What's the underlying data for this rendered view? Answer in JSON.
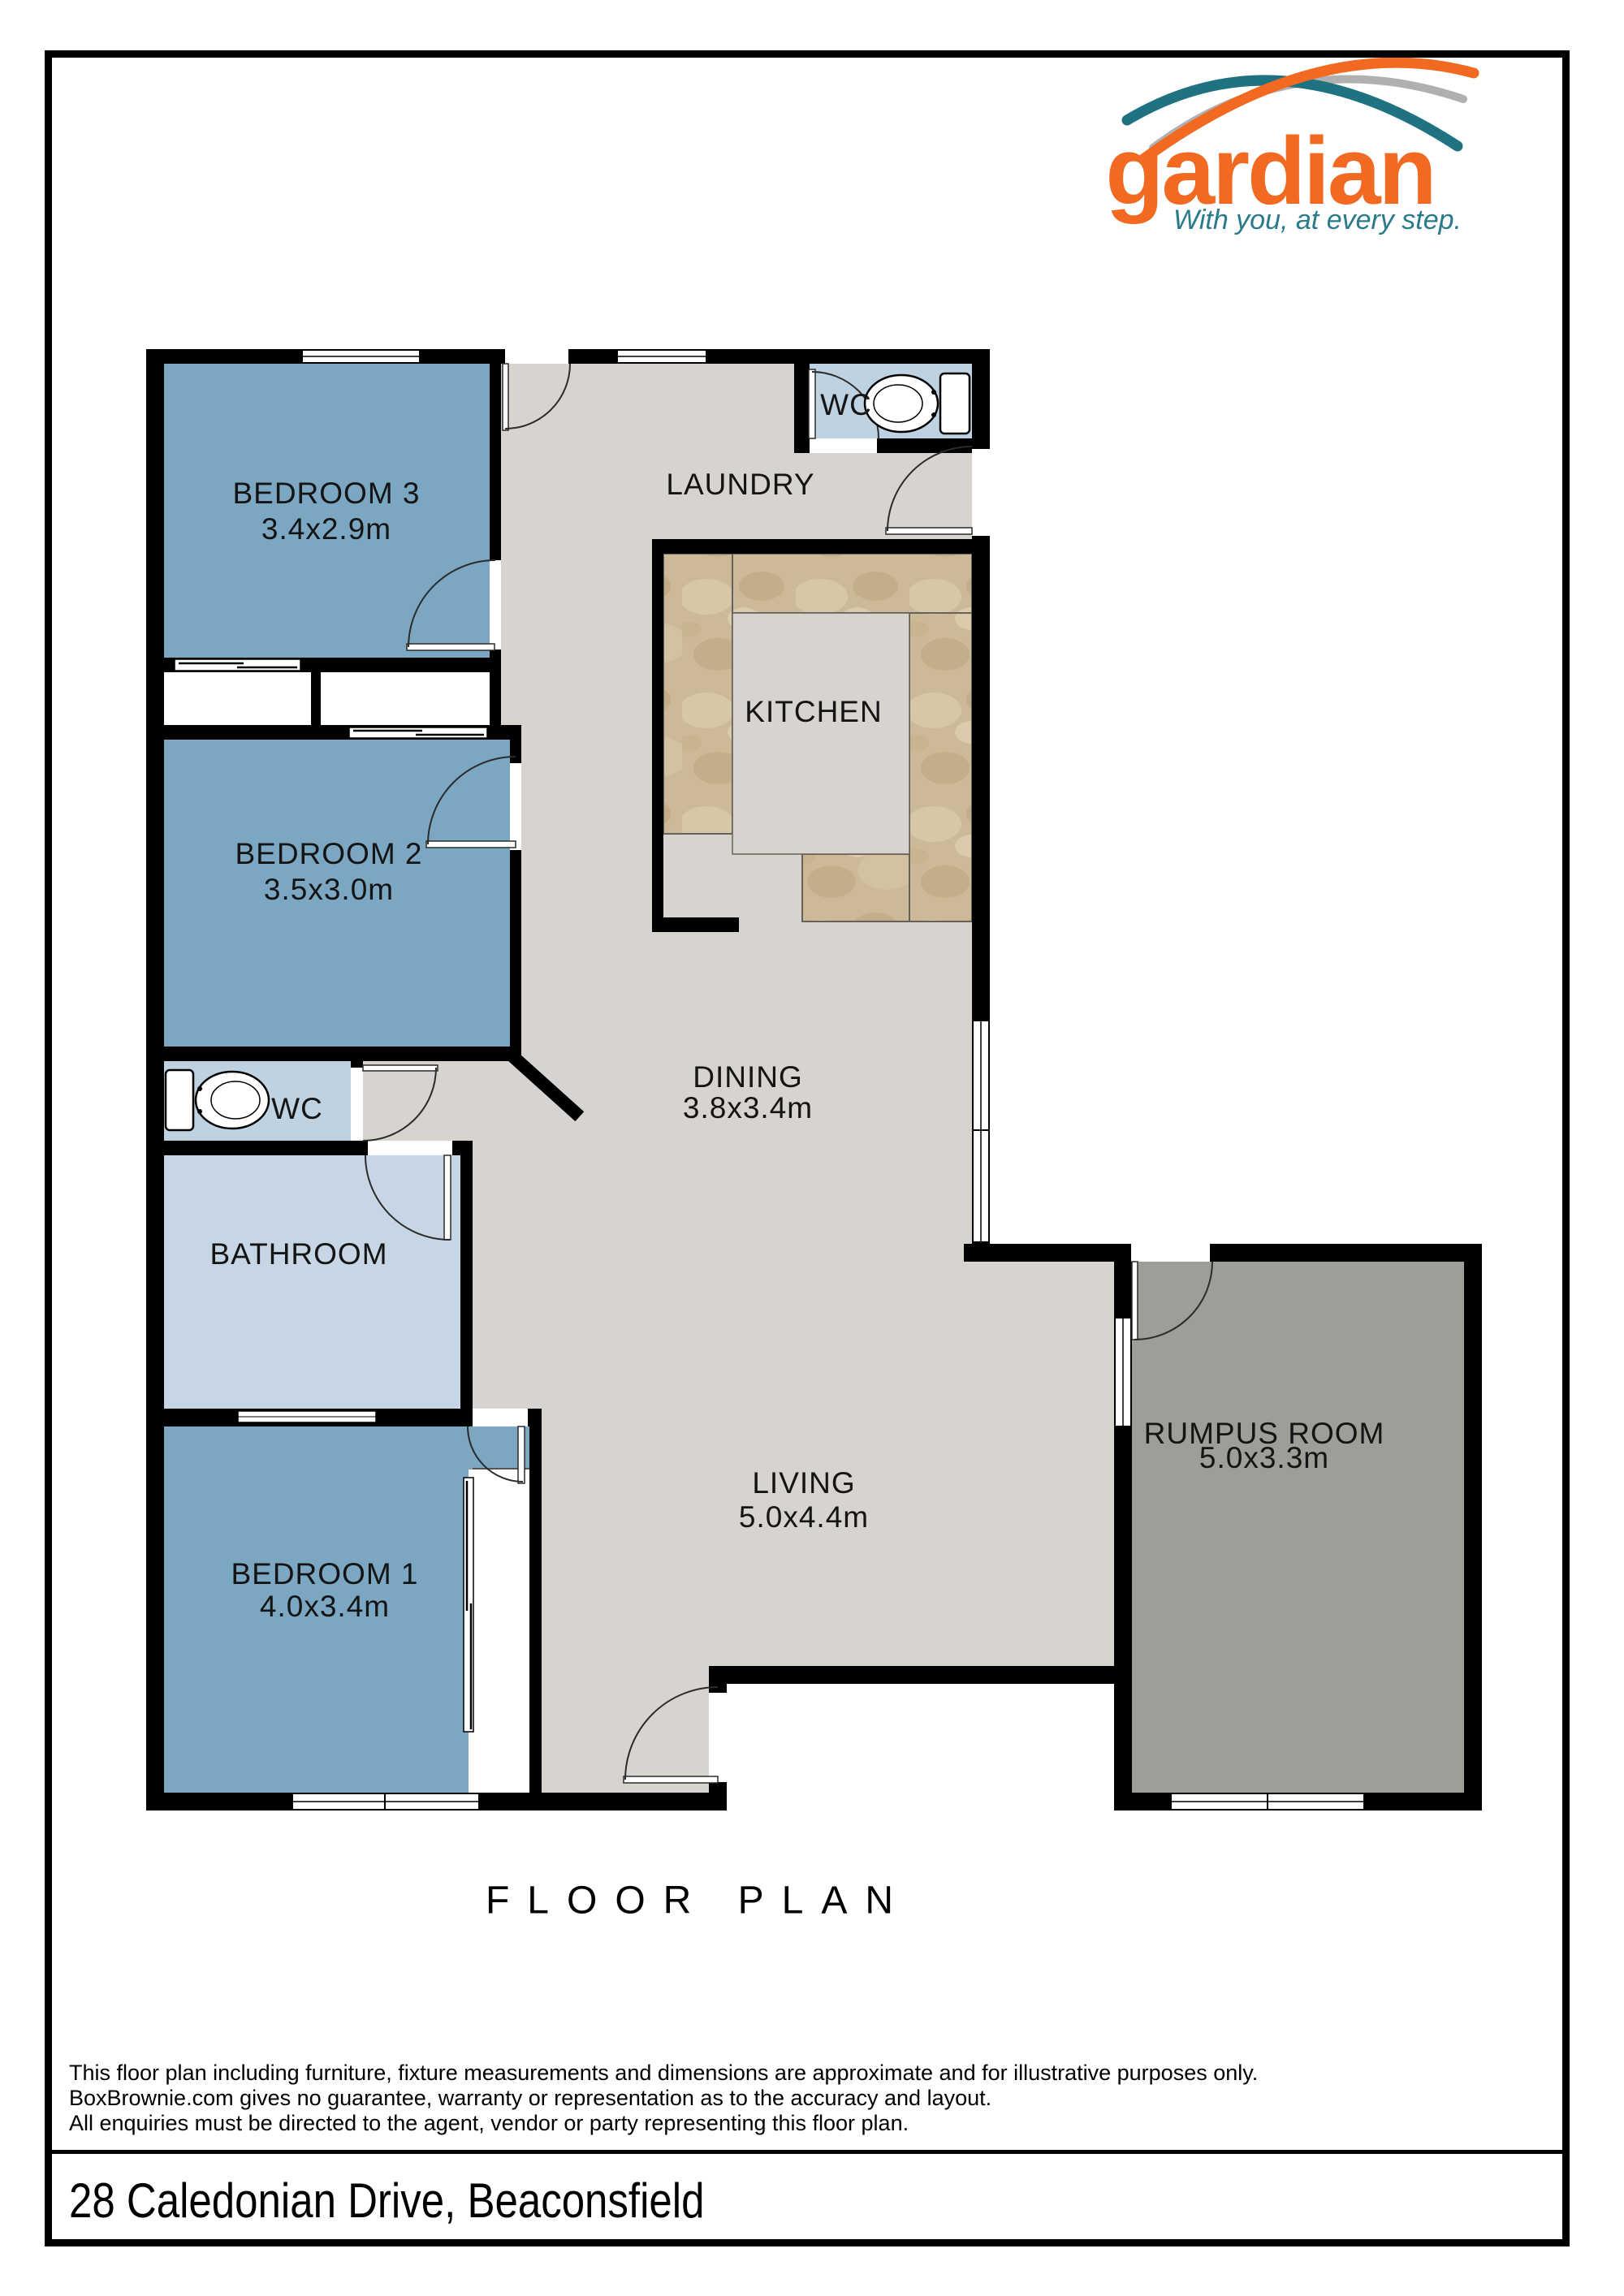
{
  "page": {
    "title": "FLOOR PLAN",
    "address": "28 Caledonian Drive, Beaconsfield",
    "disclaimer": [
      "This floor plan including furniture, fixture measurements and dimensions are approximate and for illustrative purposes only.",
      "BoxBrownie.com gives no guarantee, warranty or representation as to the accuracy and layout.",
      "All enquiries must be directed to the agent, vendor or party representing this floor plan."
    ]
  },
  "brand": {
    "name": "gardian",
    "tagline": "With you, at every step.",
    "colors": {
      "orange": "#F26A21",
      "teal": "#1F7281",
      "gray": "#B0B0B0",
      "tagline_teal": "#2A7A8C"
    }
  },
  "rooms": {
    "bedroom3": {
      "name": "BEDROOM 3",
      "dims": "3.4x2.9m"
    },
    "bedroom2": {
      "name": "BEDROOM 2",
      "dims": "3.5x3.0m"
    },
    "bedroom1": {
      "name": "BEDROOM 1",
      "dims": "4.0x3.4m"
    },
    "laundry": {
      "name": "LAUNDRY"
    },
    "kitchen": {
      "name": "KITCHEN"
    },
    "dining": {
      "name": "DINING",
      "dims": "3.8x3.4m"
    },
    "living": {
      "name": "LIVING",
      "dims": "5.0x4.4m"
    },
    "rumpus": {
      "name": "RUMPUS ROOM",
      "dims": "5.0x3.3m"
    },
    "bathroom": {
      "name": "BATHROOM"
    },
    "wc_top": {
      "name": "WC"
    },
    "wc_middle": {
      "name": "WC"
    }
  },
  "legend_colors": {
    "bedroom_fill": "#7BA7C3",
    "wet_room_fill": "#BFD2E1",
    "bathroom_fill": "#C6D6E4",
    "floor_fill": "#D7D3CE",
    "rumpus_fill": "#9E9E99",
    "kitchen_counter": "#CBB997",
    "wall": "#000000"
  }
}
